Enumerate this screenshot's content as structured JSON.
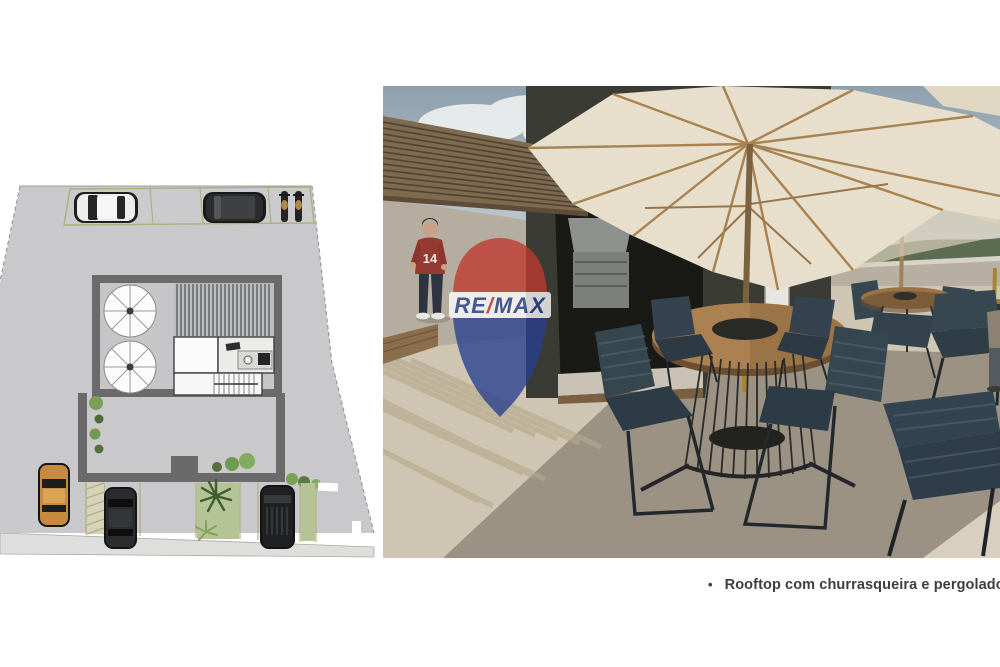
{
  "page": {
    "background": "#ffffff",
    "width": 1000,
    "height": 667
  },
  "caption": {
    "bullet": "•",
    "text": "Rooftop com churrasqueira e pergolado"
  },
  "watermark": {
    "re": "RE",
    "slash": "/",
    "max": "MAX",
    "red": "#c0392f",
    "blue": "#27408f",
    "band": "#ffffff"
  },
  "person": {
    "jersey_number": "14",
    "shirt_color": "#943a33",
    "pants_color": "#2f3540"
  },
  "floor_plan": {
    "label": "site-plan",
    "palette": {
      "ground": "#c9c9cb",
      "wall": "#6a6a6a",
      "parking_line": "#b2ae7c",
      "grass": "#b5c497",
      "palm": "#3f5c33",
      "car_dark": "#2b2c2e",
      "car_white": "#ededed",
      "car_orange": "#c78a3e",
      "sidewalk": "#dedeDC",
      "stripe": "#55565a",
      "room_white": "#fbfbfb"
    },
    "contents": [
      "top parking strip with white car, dark car, two motorcycles",
      "rooftop terrace plan with two parasols",
      "pergola slat area",
      "service room",
      "barbecue kitchen with counter and sink",
      "stair core",
      "walled courtyard with shrubs",
      "street parking with orange car, two dark cars, palm trees and grass strips",
      "sidewalk along bottom"
    ]
  },
  "photo": {
    "label": "rooftop-render",
    "palette": {
      "sky_top": "#8da0ad",
      "sky_bottom": "#d3dadd",
      "cloud": "#eef1f1",
      "pergola_wood": "#7e6a4e",
      "pergola_gap": "#4f4234",
      "wall_dark": "#3a3b34",
      "interior": "#191a16",
      "wall_light": "#b5ada0",
      "floor_light": "#cfc5b3",
      "floor_dark": "#9b9284",
      "floor_bright": "#d8cfbe",
      "umbrella": "#e7dfcc",
      "umbrella_rib": "#a8824f",
      "pole_brass": "#a9842e",
      "table_wood": "#9a7446",
      "chair_navy": "#36464f",
      "chair_frame": "#23282c",
      "parapet": "#b6afa2",
      "treeline": "#5d6b51",
      "grill_steel": "#8e908d",
      "door_white": "#e8e6e1"
    },
    "contents": [
      "wood slat pergola ceiling",
      "dark charcoal barbecue volume with built-in grill",
      "white door and window",
      "man in red jersey number 14",
      "two large cream market umbrellas",
      "round wood dining table with wire base",
      "navy rope chairs",
      "second dining set near parapet",
      "third set cropped at right edge",
      "parapet wall with treeline beyond",
      "concrete floor with pergola shadow stripes",
      "RE/MAX balloon watermark"
    ]
  }
}
